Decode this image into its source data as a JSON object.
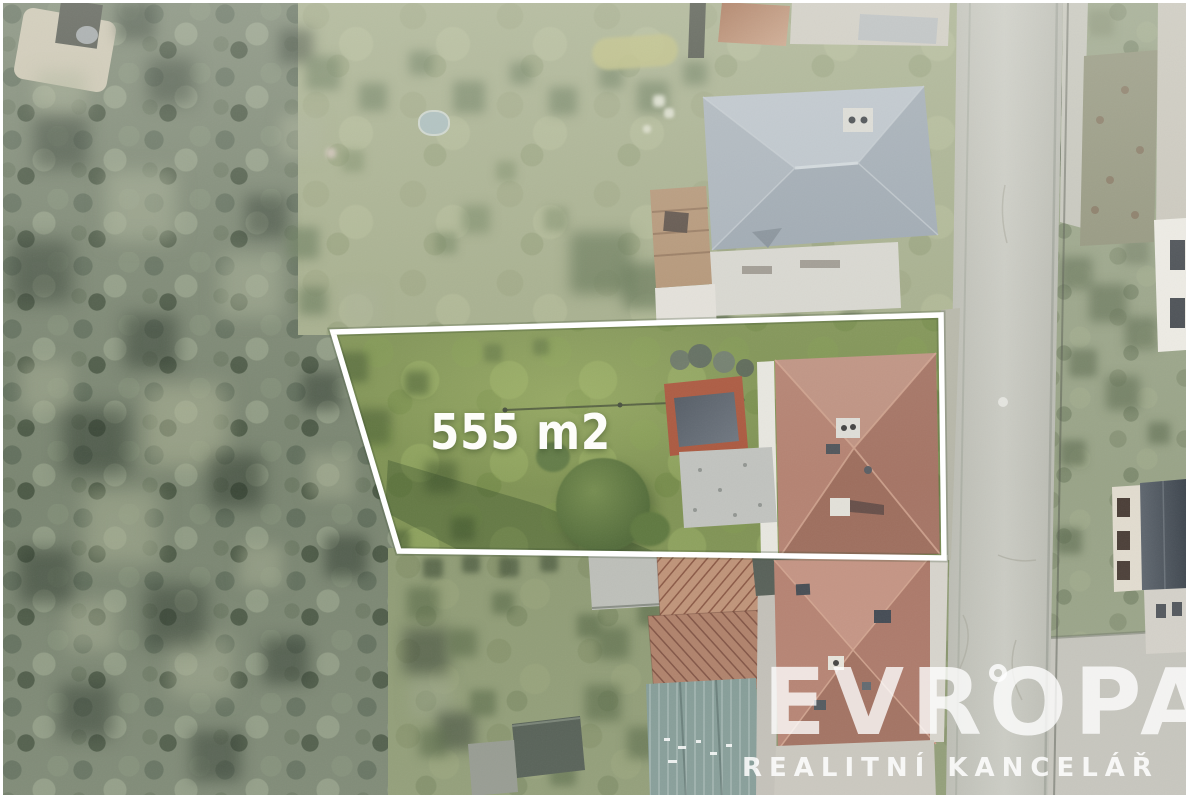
{
  "image": {
    "alt": "Aerial drone photo of a building plot for sale, outlined in white",
    "width_px": 1199,
    "height_px": 799
  },
  "plot": {
    "area_label": "555 m2",
    "boundary_color": "#ffffff",
    "boundary_points": [
      [
        333,
        332
      ],
      [
        941,
        315
      ],
      [
        944,
        558
      ],
      [
        399,
        551
      ]
    ]
  },
  "watermark": {
    "brand": "EVROPA",
    "tagline": "REALITNÍ KANCELÁŘ",
    "color": "#ffffff"
  },
  "palette": {
    "forest": "#75816c",
    "lawn": "#a2ab88",
    "plot_grass": "#7b8f4e",
    "road": "#c1c2ba",
    "gray_roof": "#a9b3bc",
    "plot_house_roof": "#ab7868",
    "bottom_house_roof": "#b5806d",
    "teal_building": "#7e9792",
    "garage_rust": "#a85238",
    "boundary": "#ffffff"
  }
}
